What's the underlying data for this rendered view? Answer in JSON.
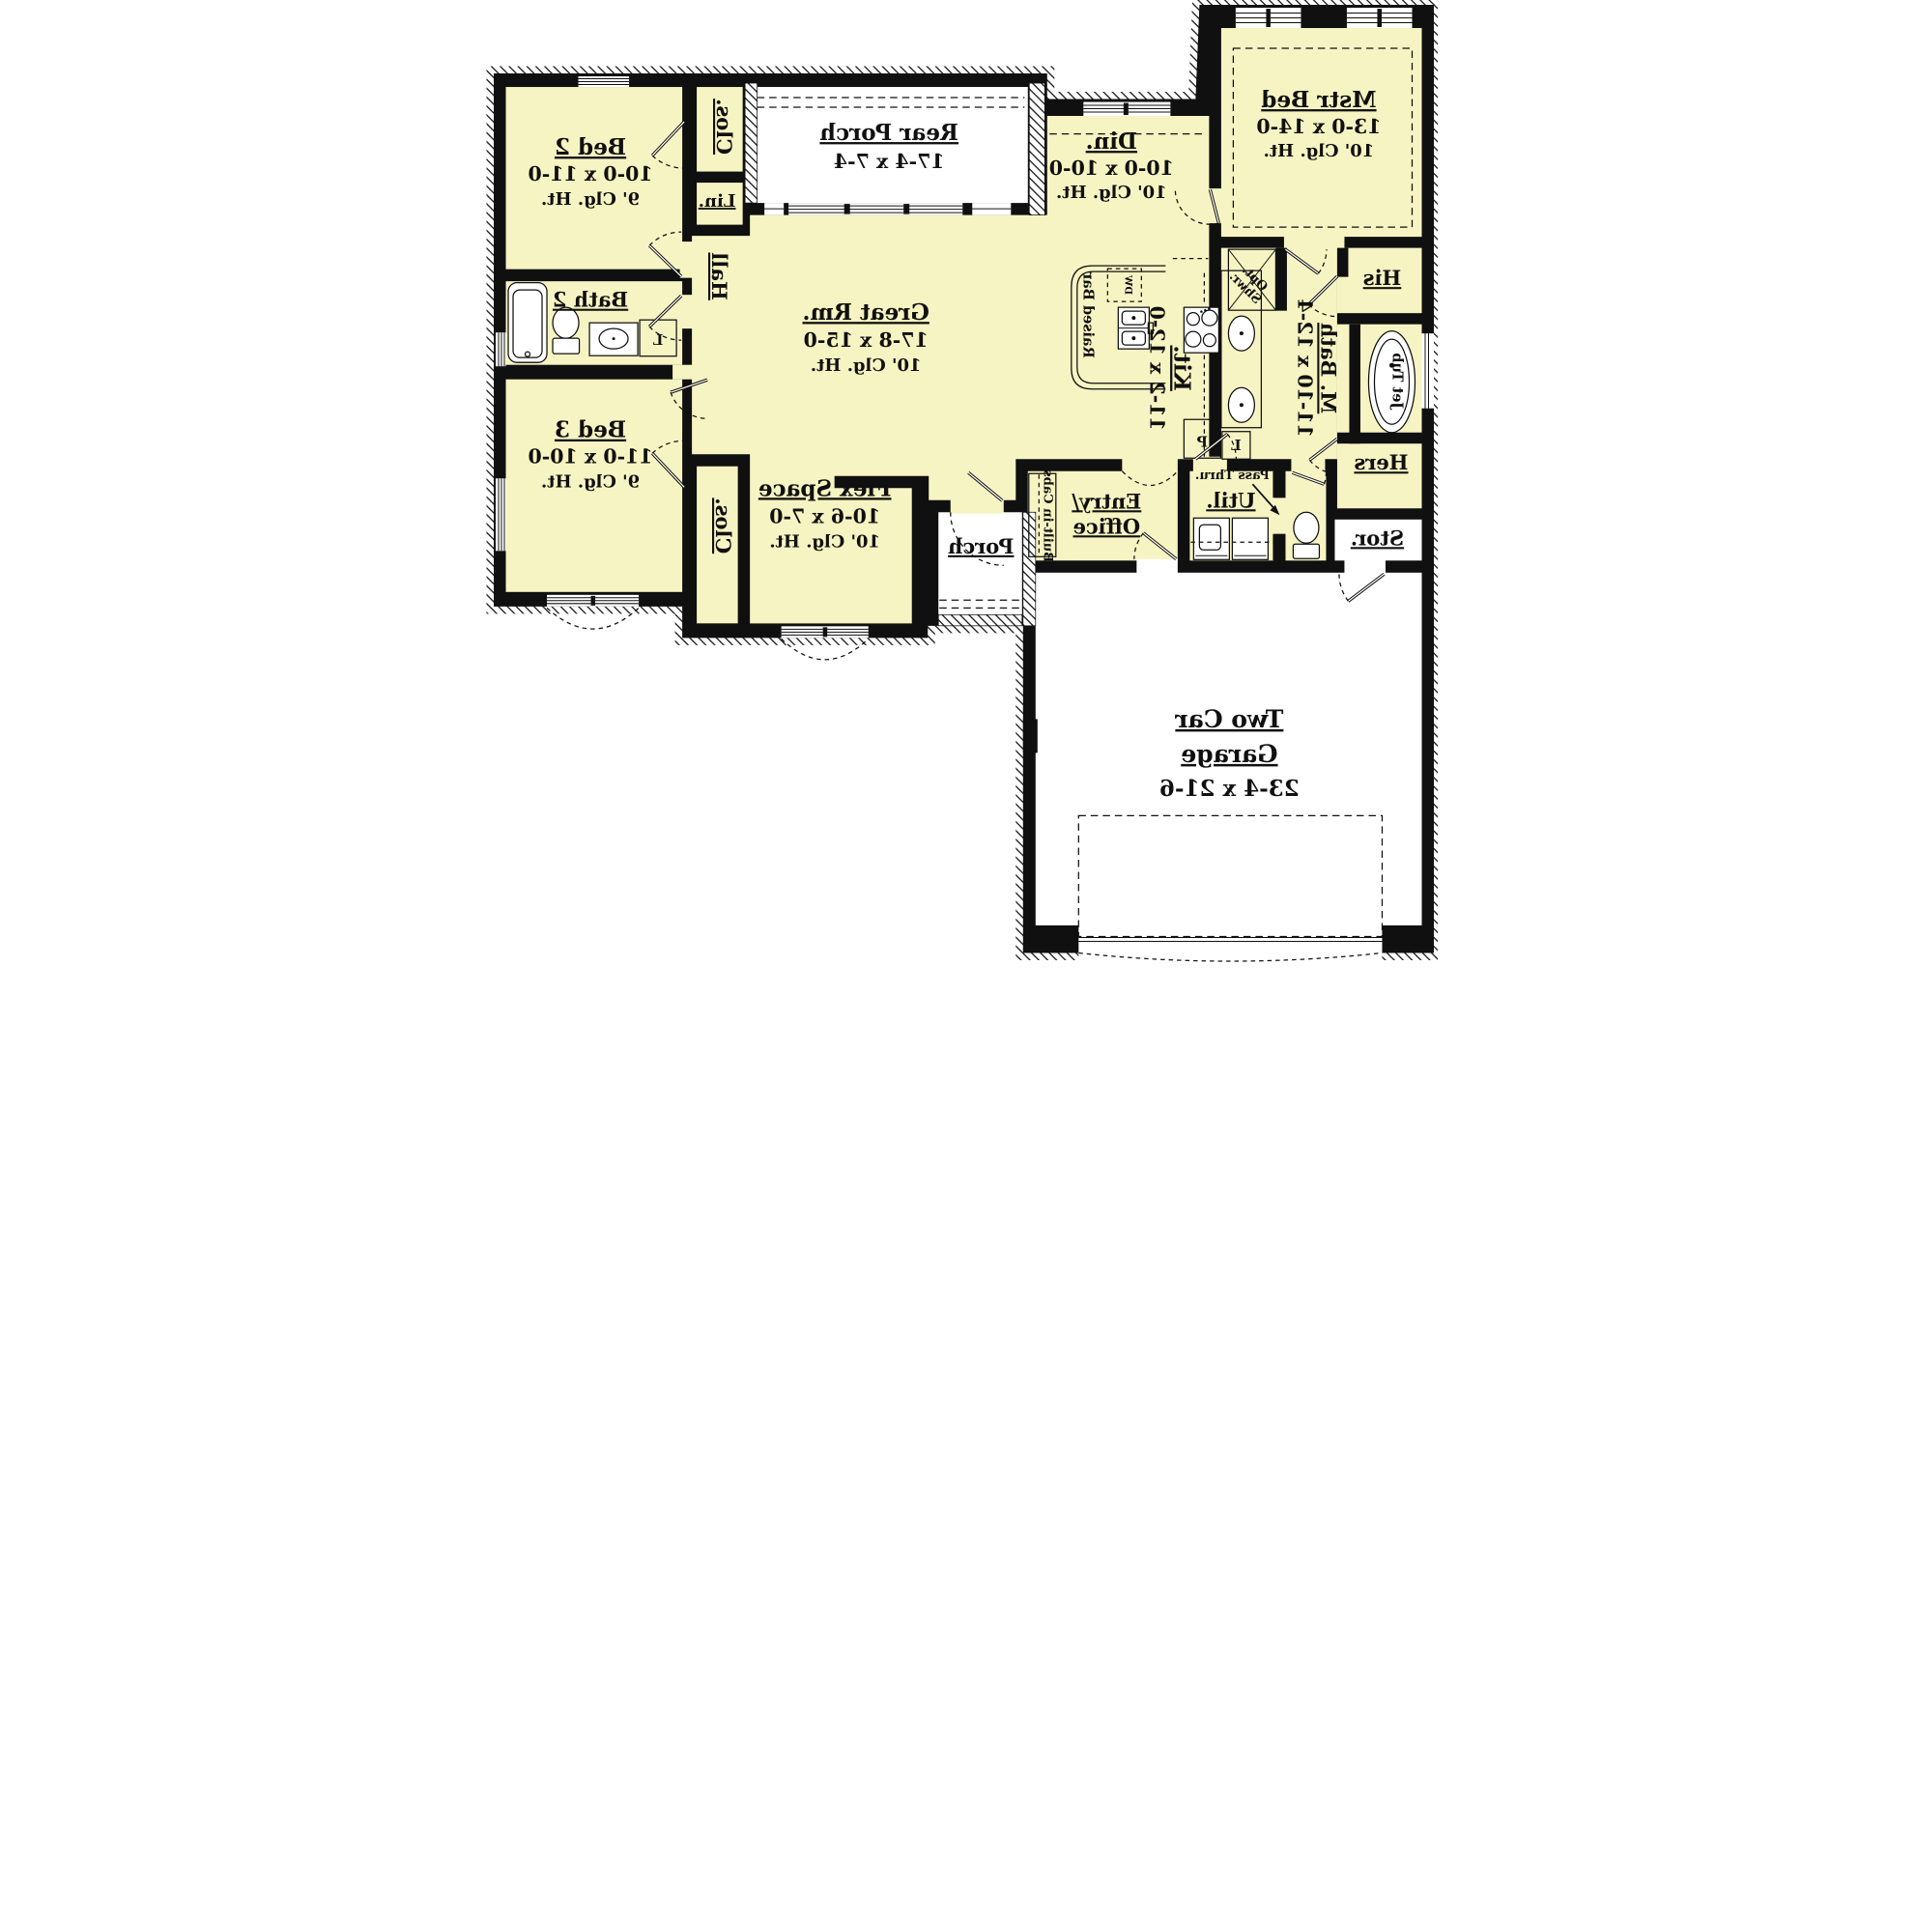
{
  "plan": {
    "rooms": {
      "bed2": {
        "name": "Bed 2",
        "dims": "10-0 x 11-0",
        "clg": "9' Clg. Ht."
      },
      "bed3": {
        "name": "Bed 3",
        "dims": "11-0 x 10-0",
        "clg": "9' Clg. Ht."
      },
      "mstr": {
        "name": "Mstr Bed",
        "dims": "13-0 x 14-0",
        "clg": "10' Clg. Ht."
      },
      "din": {
        "name": "Din.",
        "dims": "10-0 x 10-0",
        "clg": "10' Clg. Ht."
      },
      "great": {
        "name": "Great Rm.",
        "dims": "17-8 x 15-0",
        "clg": "10' Clg. Ht."
      },
      "rear_porch": {
        "name": "Rear Porch",
        "dims": "17-4 x 7-4"
      },
      "flex": {
        "name": "Flex Space",
        "dims": "10-6 x 7-0",
        "clg": "10' Clg. Ht."
      },
      "kit": {
        "name": "Kit.",
        "dims": "11-2 x 12-0"
      },
      "mbath": {
        "name": "M. Bath",
        "dims": "11-10 x 12-4"
      },
      "garage": {
        "line1": "Two Car",
        "line2": "Garage",
        "dims": "23-4 x 21-6"
      },
      "entry": {
        "line1": "Entry/",
        "line2": "Office"
      },
      "util": {
        "name": "Util."
      },
      "bath2": {
        "name": "Bath 2"
      },
      "porch": {
        "name": "Porch"
      },
      "stor": {
        "name": "Stor."
      },
      "hall": {
        "name": "Hall"
      },
      "his": {
        "name": "His"
      },
      "hers": {
        "name": "Hers"
      }
    },
    "labels": {
      "clos": "Clos.",
      "lin": "Lin.",
      "linen": "L",
      "pantry": "P",
      "dw": "DW",
      "pass_thru": "Pass Thru.",
      "jet_tub": "Jet Tub",
      "raised_bar": "Raised Bar",
      "built_in_cabs": "Built-in Cabs",
      "opt": "Opt.",
      "shwr": "Shwr."
    },
    "colors": {
      "floor": "#F7F4C3",
      "wall": "#101010",
      "exterior": "#FFFFFF"
    }
  }
}
